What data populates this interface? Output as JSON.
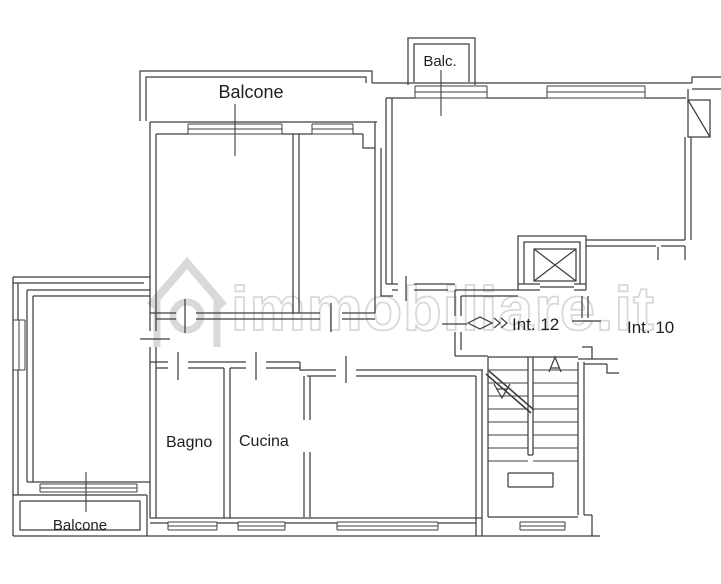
{
  "floorplan": {
    "watermark": {
      "text": "immobiliare.it",
      "icon": "house-logo-icon",
      "color": "#d9d9d9"
    },
    "colors": {
      "background": "#ffffff",
      "wall_line": "#3f3f3f",
      "label_text": "#1f1f1f"
    },
    "labels": {
      "balcony_top": "Balcone",
      "balcony_small": "Balc.",
      "unit_entrance": "Int. 12",
      "unit_neighbor": "Int. 10",
      "bathroom": "Bagno",
      "kitchen": "Cucina",
      "balcony_bottom": "Balcone"
    },
    "symbols": {
      "entrance_marker": "diamond-chevron-icon",
      "elevator": "crossed-square-icon",
      "stairs_up": "open-arrow-up-icon",
      "stairs_down": "open-arrow-down-icon"
    }
  }
}
